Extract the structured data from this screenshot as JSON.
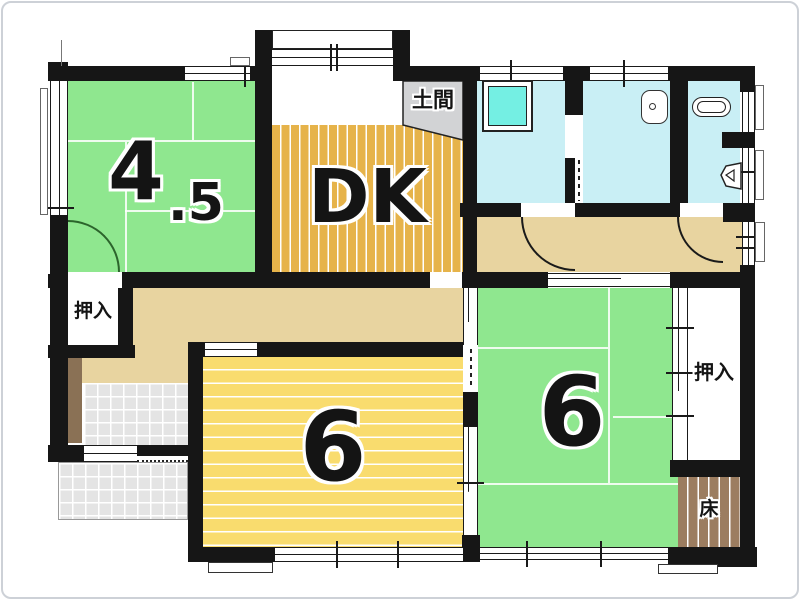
{
  "floorplan": {
    "labels": {
      "room45_main": "4",
      "room45_sub": ".5",
      "dk": "DK",
      "doma": "土間",
      "closet_left": "押入",
      "closet_right": "押入",
      "room6_center": "6",
      "room6_right": "6",
      "toko": "床"
    },
    "colors": {
      "tatami_green": "#8fe78f",
      "dk_gold": "#e6b34a",
      "room_yellow": "#f9dc6e",
      "hallway_tan": "#e8d4a0",
      "bath_cyan": "#c9eff5",
      "tub_cyan": "#74efe3",
      "doma_gray": "#d2d3d5",
      "tile_gray": "#e4e4e4",
      "wood_brown": "#8a7155",
      "toko_brown": "#9c7d60",
      "wall_black": "#161616"
    }
  }
}
